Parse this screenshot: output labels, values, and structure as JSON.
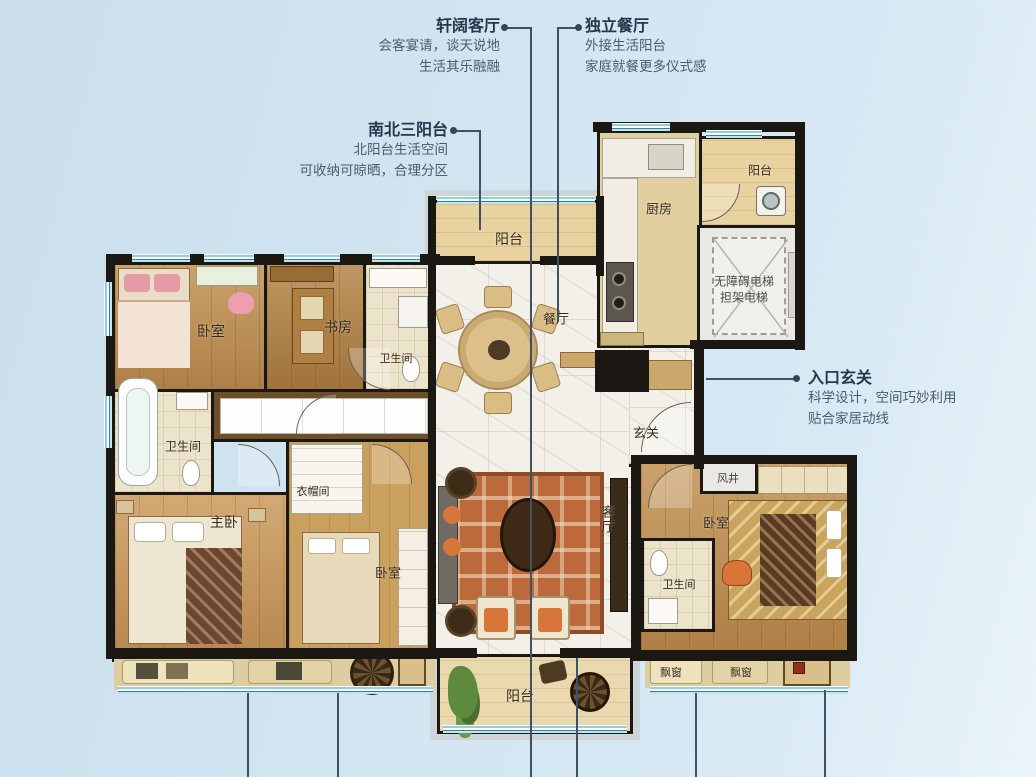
{
  "annotations": {
    "living": {
      "title": "轩阔客厅",
      "line1": "会客宴请，谈天说地",
      "line2": "生活其乐融融"
    },
    "dining": {
      "title": "独立餐厅",
      "line1": "外接生活阳台",
      "line2": "家庭就餐更多仪式感"
    },
    "balconies": {
      "title": "南北三阳台",
      "line1": "北阳台生活空间",
      "line2": "可收纳可晾晒，合理分区"
    },
    "entry": {
      "title": "入口玄关",
      "line1": "科学设计，空间巧妙利用",
      "line2": "贴合家居动线"
    }
  },
  "rooms": {
    "north_balcony": "阳台",
    "kitchen": "厨房",
    "ne_balcony": "阳台",
    "elevator_line1": "无障碍电梯",
    "elevator_line2": "担架电梯",
    "dining": "餐厅",
    "entry_hall": "玄关",
    "bedroom_tl": "卧室",
    "study": "书房",
    "bath_top": "卫生间",
    "bath_left": "卫生间",
    "master": "主卧",
    "cloakroom": "衣帽间",
    "bedroom_bm": "卧室",
    "living": "客厅",
    "south_balcony": "阳台",
    "vent": "风井",
    "bedroom_r": "卧室",
    "bath_r": "卫生间",
    "bay_r1": "飘窗",
    "bay_r2": "飘窗"
  },
  "colors": {
    "background": "#d2e5f1",
    "wall": "#1b1712",
    "window_teal": "#8fd0e0",
    "marble": "#f3f0e9",
    "wood": "#c08c4e",
    "rug": "#bc6a3c",
    "annotation_title": "#24384c",
    "annotation_body": "#485c6e"
  }
}
